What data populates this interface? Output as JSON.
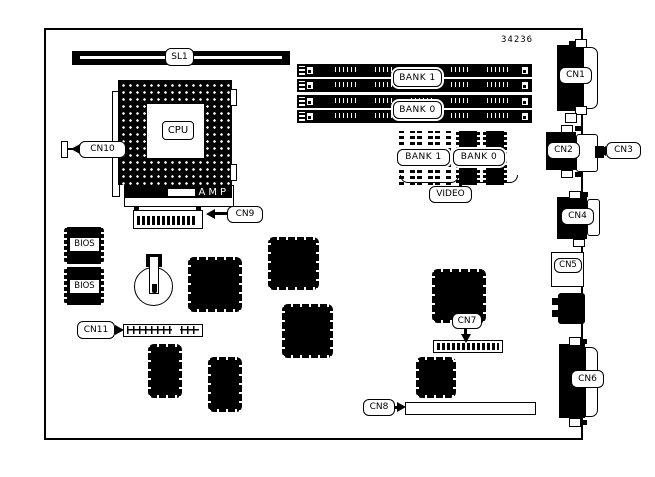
{
  "board": {
    "part_number": "34236",
    "colors": {
      "ink": "#000000",
      "board_fill": "#ffffff"
    },
    "labels": {
      "sl1": "SL1",
      "cpu": "CPU",
      "amp": "AMP",
      "video": "VIDEO"
    },
    "connector_labels": {
      "cn1": "CN1",
      "cn2": "CN2",
      "cn3": "CN3",
      "cn4": "CN4",
      "cn5": "CN5",
      "cn6": "CN6",
      "cn7": "CN7",
      "cn8": "CN8",
      "cn9": "CN9",
      "cn10": "CN10",
      "cn11": "CN11"
    },
    "memory": {
      "simm_banks": [
        "BANK 1",
        "BANK 0"
      ],
      "video_banks": [
        "BANK 1",
        "BANK 0"
      ]
    },
    "bios_chips": [
      "BIOS",
      "BIOS"
    ]
  }
}
